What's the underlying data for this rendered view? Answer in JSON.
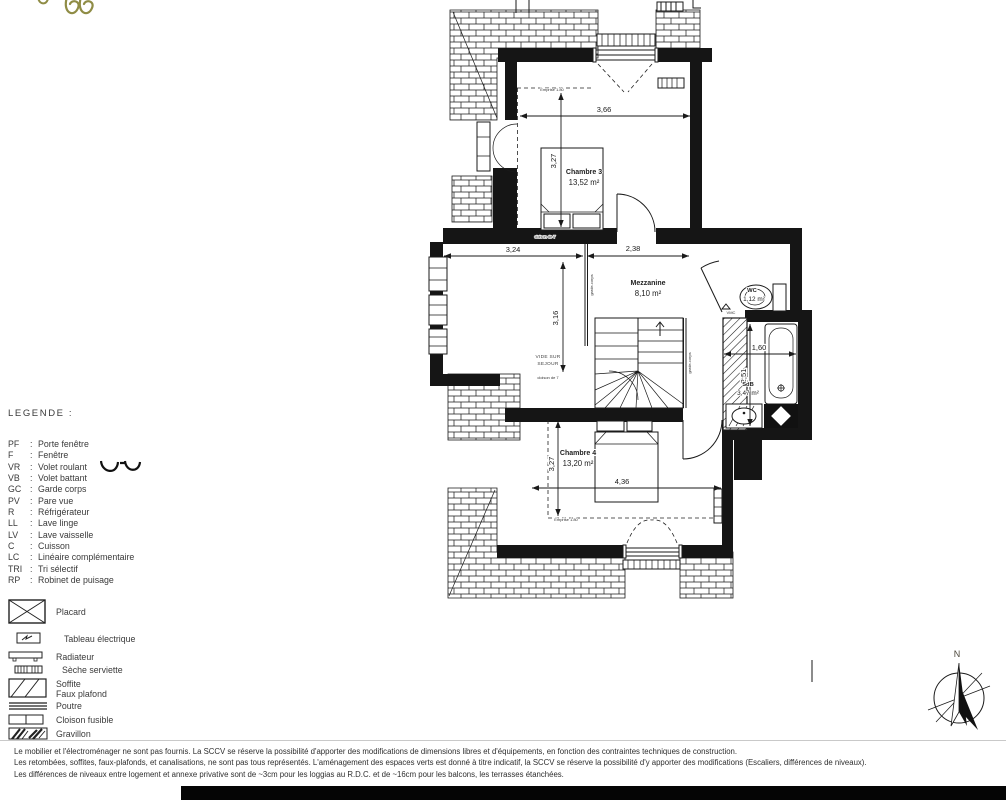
{
  "colors": {
    "ink": "#1a1a1a",
    "text": "#3a3a3a",
    "accent": "#8f8c45",
    "background": "#ffffff"
  },
  "legend": {
    "title": "LEGENDE  :",
    "separator": ":",
    "abbreviations": [
      {
        "abbr": "PF",
        "label": "Porte fenêtre"
      },
      {
        "abbr": "F",
        "label": "Fenêtre"
      },
      {
        "abbr": "VR",
        "label": "Volet roulant"
      },
      {
        "abbr": "VB",
        "label": "Volet battant"
      },
      {
        "abbr": "GC",
        "label": "Garde corps"
      },
      {
        "abbr": "PV",
        "label": "Pare vue"
      },
      {
        "abbr": "R",
        "label": "Réfrigérateur"
      },
      {
        "abbr": "LL",
        "label": "Lave linge"
      },
      {
        "abbr": "LV",
        "label": "Lave vaisselle"
      },
      {
        "abbr": "C",
        "label": "Cuisson"
      },
      {
        "abbr": "LC",
        "label": "Linéaire complémentaire"
      },
      {
        "abbr": "TRI",
        "label": "Tri sélectif"
      },
      {
        "abbr": "RP",
        "label": "Robinet de puisage"
      }
    ],
    "symbols": [
      {
        "label": "Placard"
      },
      {
        "label": "Tableau électrique"
      },
      {
        "label": "Radiateur"
      },
      {
        "label": "Sèche serviette"
      },
      {
        "label": "Soffite",
        "label2": "Faux plafond"
      },
      {
        "label": "Poutre"
      },
      {
        "label": "Cloison fusible"
      },
      {
        "label": "Gravillon"
      }
    ]
  },
  "plan": {
    "rooms": [
      {
        "name": "Chambre 3",
        "area": "13,52 m²"
      },
      {
        "name": "Mezzanine",
        "area": "8,10 m²"
      },
      {
        "name": "WC",
        "area": "1,12 m²"
      },
      {
        "name": "SdB",
        "area": "3,47 m²"
      },
      {
        "name": "Chambre 4",
        "area": "13,20 m²"
      }
    ],
    "dimensions": {
      "chambre3_width": "3,66",
      "chambre3_height": "3,27",
      "mezzanine_left": "3,24",
      "mezzanine_right": "2,38",
      "mezzanine_height": "3,16",
      "sdb_width": "1,60",
      "sdb_height": "2,51",
      "chambre4_height": "3,27",
      "chambre4_width": "4,36"
    },
    "annotations": {
      "vide_line1": "VIDE SUR",
      "vide_line2": "SEJOUR",
      "garde_corps": "garde-corps",
      "emprise": "Emprise 1.80",
      "cloison": "cloison de 7",
      "vmc": "VMC"
    },
    "compass": {
      "north": "N"
    }
  },
  "footer": {
    "lines": [
      "Le mobilier et l'électroménager ne sont pas fournis. La SCCV se réserve la possibilité d'apporter des modifications de dimensions libres  et d'équipements, en fonction des contraintes techniques de construction.",
      "Les retombées, soffites, faux-plafonds, et canalisations, ne sont pas tous représentés. L'aménagement des espaces verts est donné à titre indicatif, la SCCV se réserve la possibilité d'y apporter des modifications (Escaliers, différences de niveaux).",
      "Les différences de niveaux entre logement et annexe privative sont de ~3cm pour les loggias au R.D.C. et de ~16cm pour les balcons, les terrasses étanchées."
    ]
  }
}
